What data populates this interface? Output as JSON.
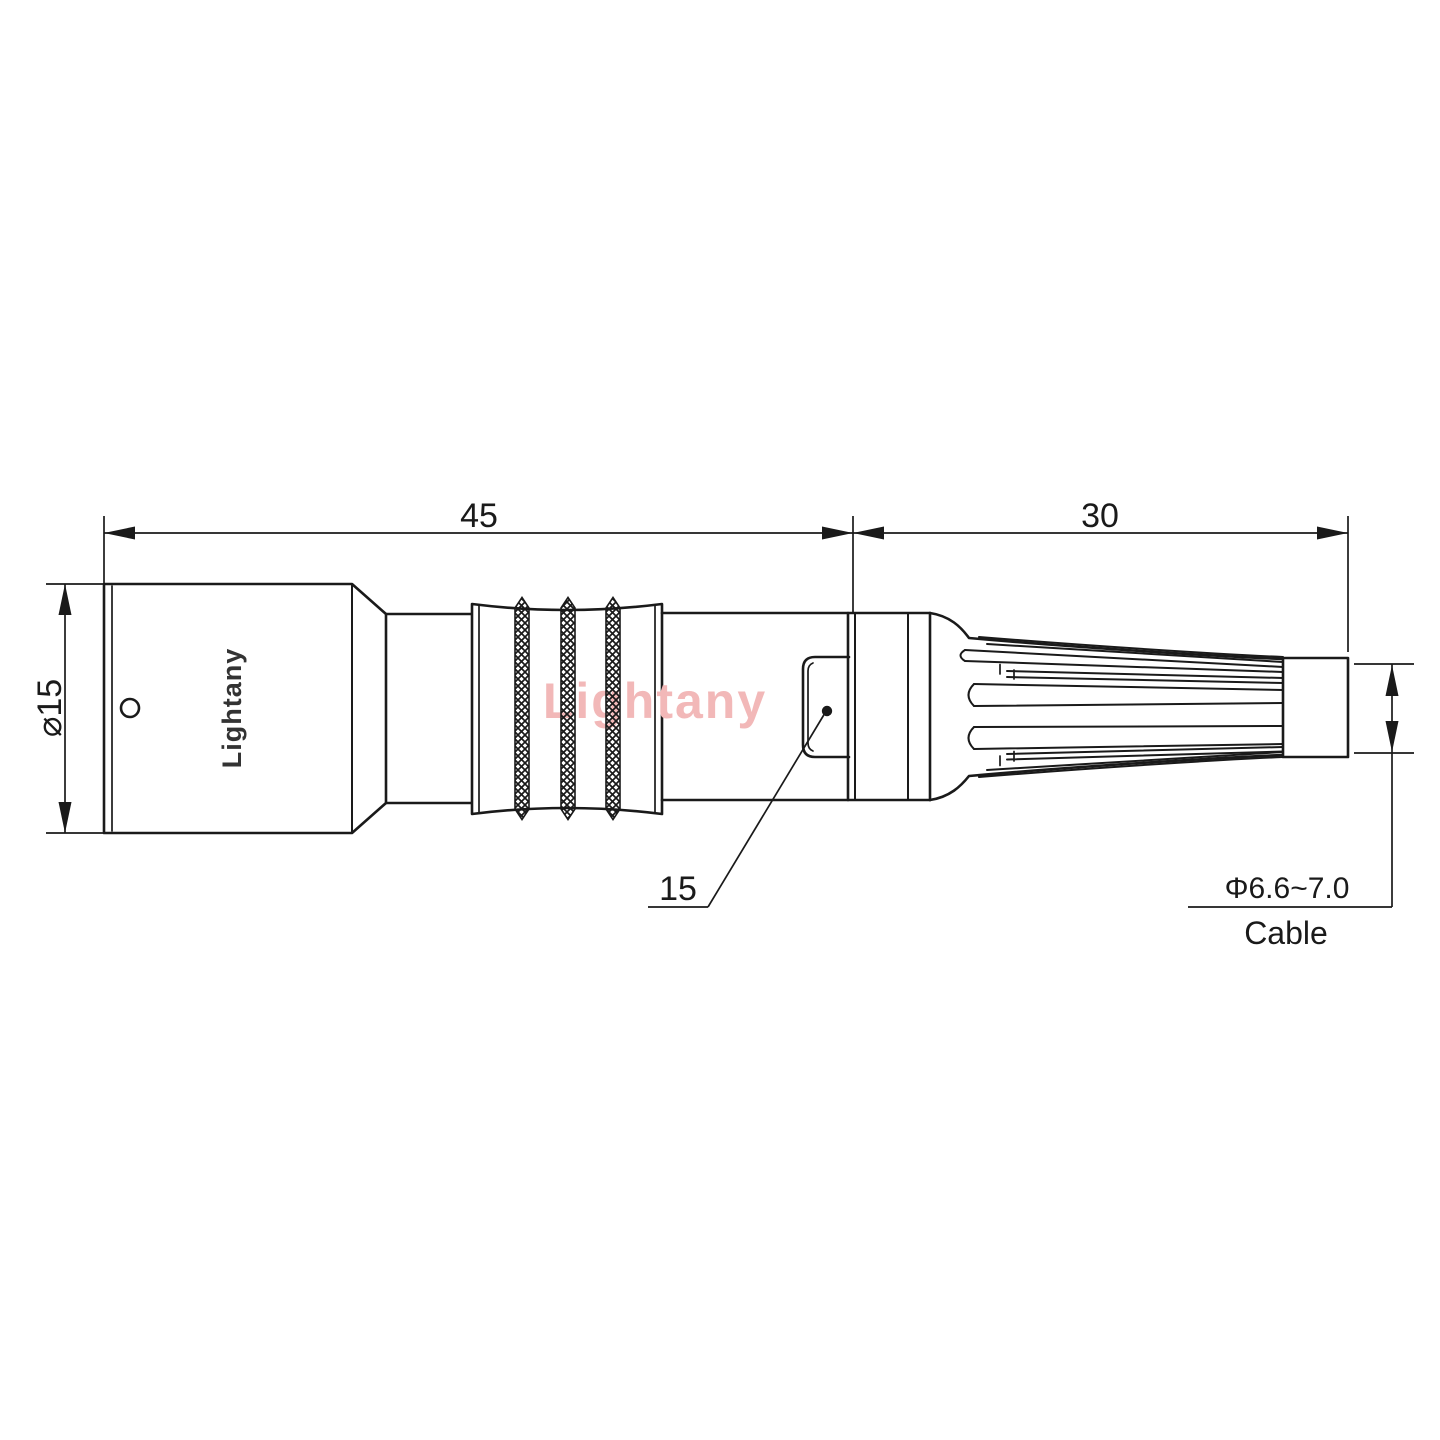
{
  "drawing": {
    "colors": {
      "line": "#1a1a1a",
      "brand_text": "#333333",
      "watermark": "#f2b8b8"
    },
    "labels": {
      "front_length": "45",
      "boot_length": "30",
      "body_diameter": "⌀15",
      "latch_dim": "15",
      "cable_diameter": "Φ6.6~7.0",
      "cable_word": "Cable",
      "brand": "Lightany",
      "watermark": "Lightany"
    }
  }
}
